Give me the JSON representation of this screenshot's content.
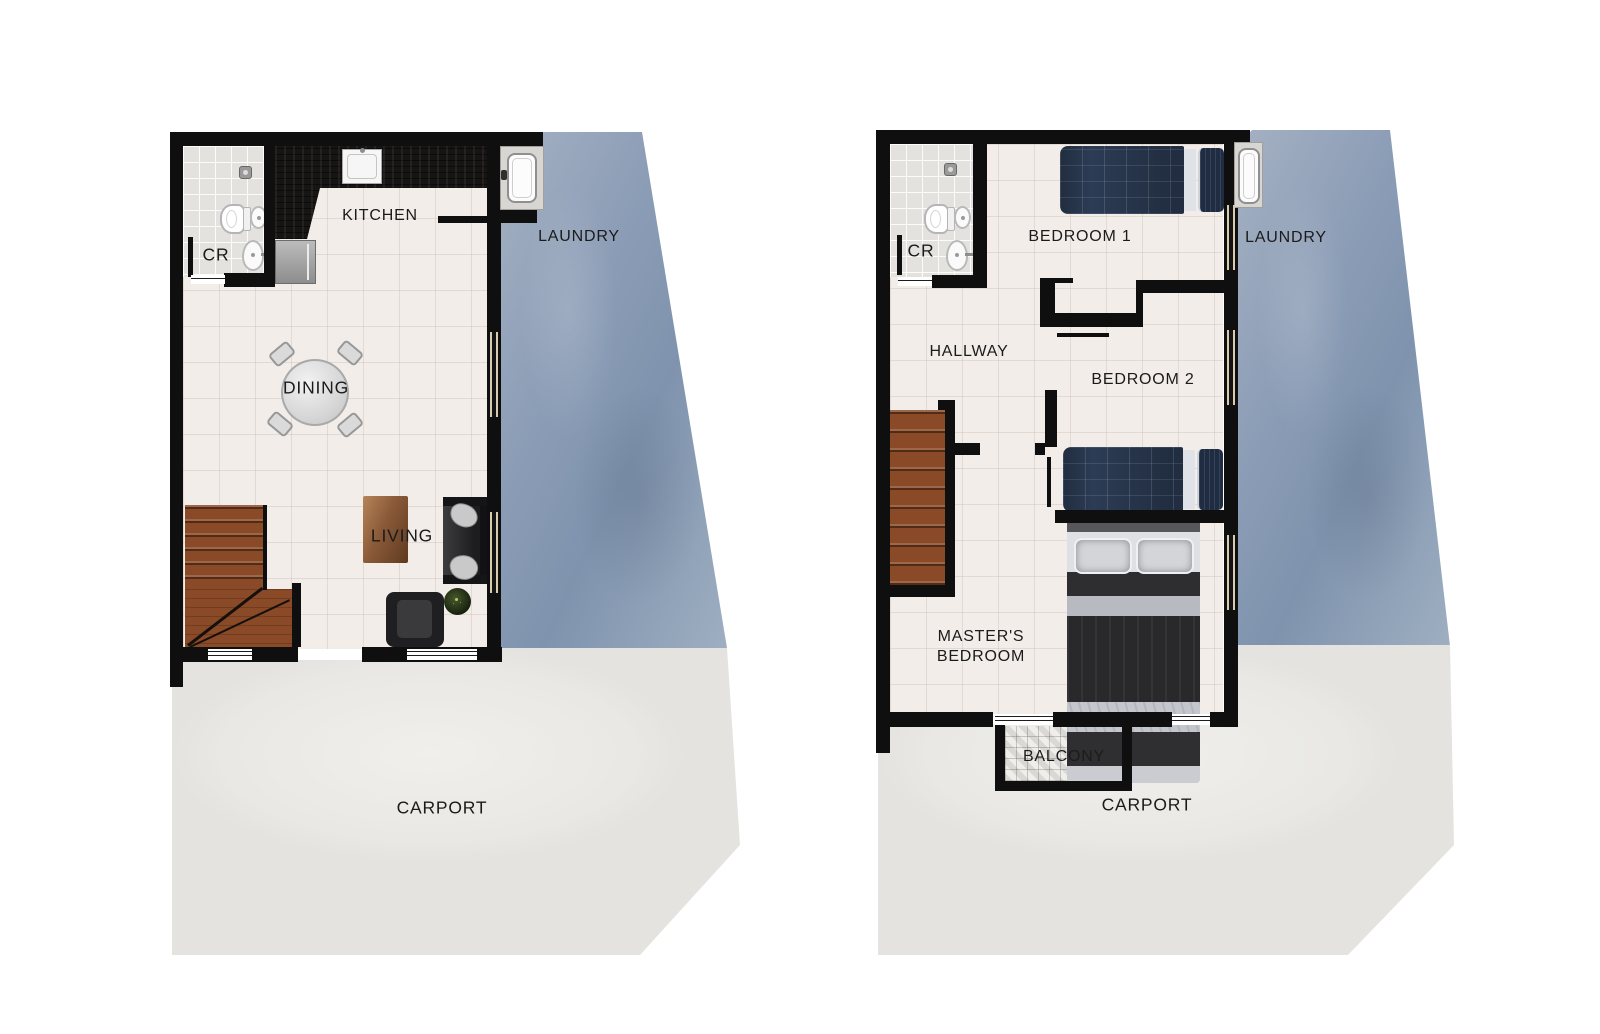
{
  "document": {
    "kind": "floor-plan-rendering",
    "background": "#ffffff",
    "floor_count": 2
  },
  "palette": {
    "wall": "#0f0f0f",
    "floor": "#f2ede8",
    "cr_floor": "#e4e2df",
    "laundry_zone": "#8c9db6",
    "carport_zone": "#eae9e5",
    "stairs_wood": "#8a4a28",
    "kitchen_counter": "#171514",
    "window": "#d9cbb0",
    "label": "#1b1b1b",
    "bed_blanket": "#2c3c55",
    "master_blanket": "#29292b"
  },
  "floors": [
    {
      "name": "ground-floor",
      "labels": {
        "cr": "CR",
        "kitchen": "KITCHEN",
        "laundry": "LAUNDRY",
        "dining": "DINING",
        "living": "LIVING",
        "carport": "CARPORT"
      },
      "fixtures": [
        "shower-head",
        "toilet",
        "round-basin",
        "pedestal-sink",
        "washing-machine",
        "kitchen-sink",
        "refrigerator",
        "dining-table",
        "chairs",
        "staircase",
        "sofa",
        "throw-pillows",
        "coffee-table",
        "armchair",
        "plant"
      ]
    },
    {
      "name": "second-floor",
      "labels": {
        "cr": "CR",
        "bedroom1": "BEDROOM 1",
        "laundry": "LAUNDRY",
        "hallway": "HALLWAY",
        "bedroom2": "BEDROOM 2",
        "masters_line1": "MASTER'S",
        "masters_line2": "BEDROOM",
        "balcony": "BALCONY",
        "carport": "CARPORT"
      },
      "fixtures": [
        "shower-head",
        "toilet",
        "round-basin",
        "pedestal-sink",
        "washing-machine",
        "single-bed",
        "single-bed",
        "double-bed",
        "staircase"
      ]
    }
  ]
}
